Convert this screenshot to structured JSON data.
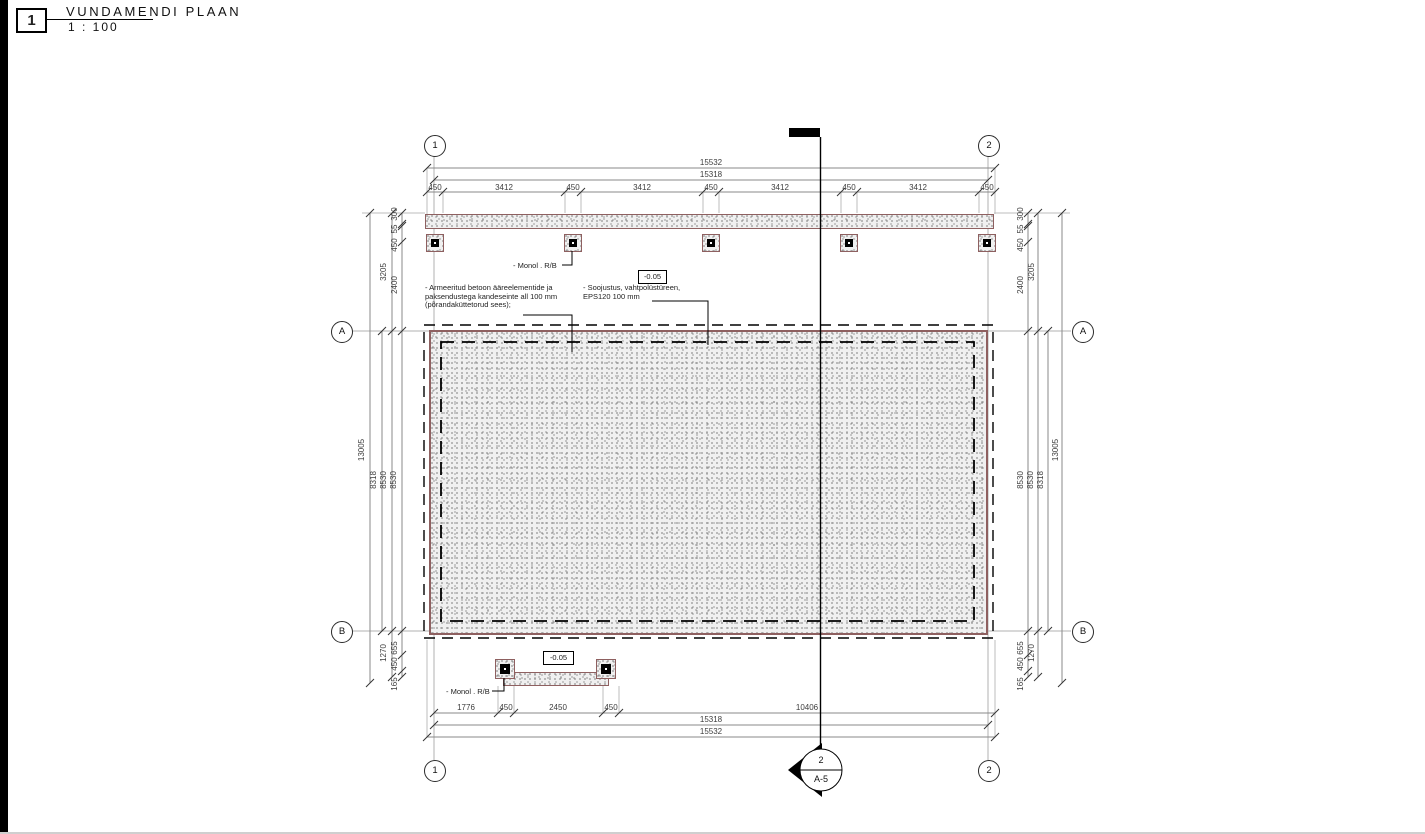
{
  "title_block": {
    "number": "1",
    "title": "VUNDAMENDI PLAAN",
    "scale": "1 : 100"
  },
  "grid_bubbles": {
    "col1": "1",
    "col2": "2",
    "rowA": "A",
    "rowB": "B"
  },
  "levels": {
    "top": "-0.05",
    "bottom": "-0.05"
  },
  "labels": {
    "monol_top": "- Monol . R/B",
    "monol_bottom": "- Monol . R/B"
  },
  "notes": {
    "note1_line1": "- Armeeritud betoon ääreelementide ja",
    "note1_line2": "paksendustega kandeseinte all 100 mm",
    "note1_line3": "(põrandaküttetorud sees);",
    "note2_line1": "- Soojustus, vahtpolüstüreen,",
    "note2_line2": "EPS120 100 mm"
  },
  "section_marker": {
    "detail": "2",
    "sheet": "A-5"
  },
  "dims": {
    "top": {
      "overall": "15532",
      "face": "15318",
      "segs": [
        "450",
        "3412",
        "450",
        "3412",
        "450",
        "3412",
        "450",
        "3412",
        "450"
      ]
    },
    "bottom": {
      "segs": [
        "1776",
        "450",
        "2450",
        "450",
        "10406"
      ],
      "face": "15318",
      "overall": "15532"
    },
    "left": {
      "chain": [
        "300",
        "55",
        "450",
        "2400"
      ],
      "total_top": "3205",
      "span": [
        "8318",
        "8530",
        "8530"
      ],
      "overall": "13005",
      "chain_bottom": [
        "655",
        "450",
        "165"
      ],
      "total_bottom": "1270"
    },
    "right": {
      "chain": [
        "300",
        "55",
        "450",
        "2400"
      ],
      "total_top": "3205",
      "span": [
        "8530",
        "8530",
        "8318"
      ],
      "overall": "13005",
      "chain_bottom": [
        "655",
        "450",
        "165"
      ],
      "total_bottom": "1270"
    }
  },
  "colors": {
    "slab_edge": "#8e6060",
    "dim_line": "#8a8a8a",
    "grid_line": "#b0b0b0",
    "section": "#000000"
  }
}
